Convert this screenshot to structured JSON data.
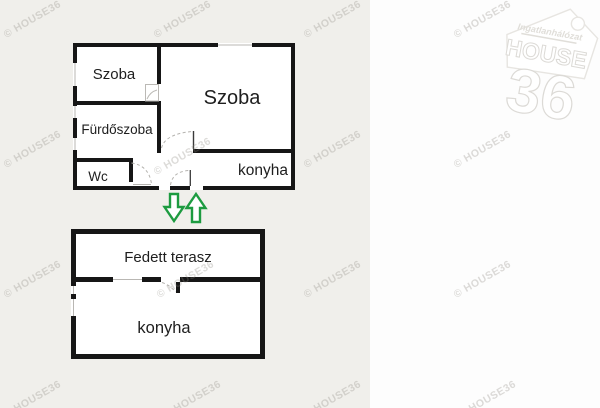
{
  "page": {
    "watermark_text": "© HOUSE36",
    "logo": {
      "network_label": "Ingatlanhálózat",
      "brand": "HOUSE",
      "number": "36"
    }
  },
  "floorplan": {
    "upper_building": {
      "room_bedroom_small": "Szoba",
      "room_bedroom_large": "Szoba",
      "room_bathroom": "Fürdőszoba",
      "room_wc": "Wc",
      "room_kitchen": "konyha"
    },
    "lower_building": {
      "room_terrace": "Fedett terasz",
      "room_kitchen": "konyha"
    },
    "icons": {
      "entry_down": "arrow-down-icon",
      "entry_up": "arrow-up-icon"
    },
    "colors": {
      "arrow_green": "#1d9b40",
      "wall_black": "#161616",
      "photo_background": "#f0efeb",
      "page_background": "#fdfdfd",
      "watermark_gray": "#8e8a82"
    }
  }
}
